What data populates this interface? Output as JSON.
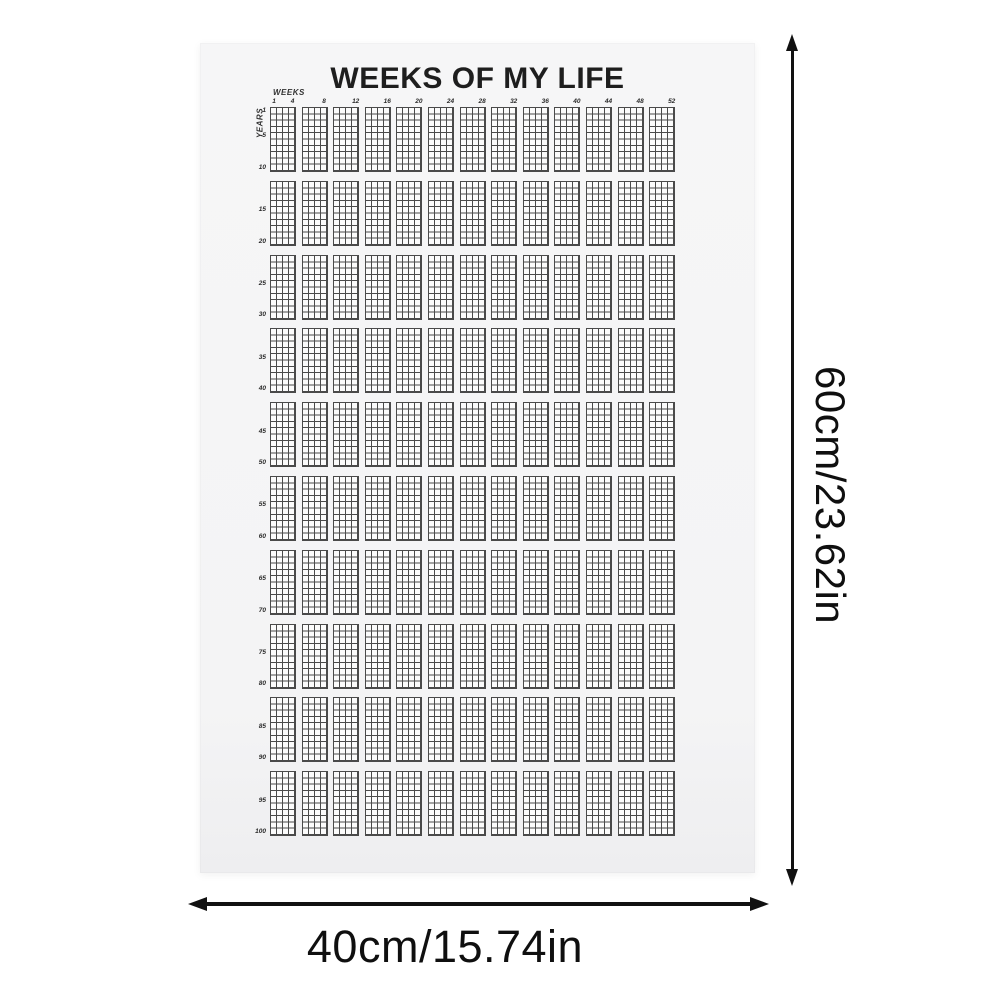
{
  "poster": {
    "title": "WEEKS OF MY LIFE",
    "weeks_axis_label": "WEEKS",
    "years_axis_label": "YEARS",
    "week_number_labels": [
      "1",
      "4",
      "8",
      "12",
      "16",
      "20",
      "24",
      "28",
      "32",
      "36",
      "40",
      "44",
      "48",
      "52"
    ],
    "year_number_labels": [
      "1",
      "5",
      "10",
      "15",
      "20",
      "25",
      "30",
      "35",
      "40",
      "45",
      "50",
      "55",
      "60",
      "65",
      "70",
      "75",
      "80",
      "85",
      "90",
      "95",
      "100"
    ],
    "grid": {
      "weeks_per_year": 52,
      "total_years": 100,
      "block_columns": 13,
      "block_rows": 10,
      "weeks_per_block": 4,
      "years_per_block": 10
    }
  },
  "dimensions": {
    "height_label": "60cm/23.62in",
    "width_label": "40cm/15.74in"
  },
  "colors": {
    "page_background": "#ffffff",
    "poster_background": "#f4f4f5",
    "grid_line": "#4a4a4a",
    "grid_cell": "#fbfbfb",
    "arrow": "#111111",
    "title_ink": "#1e1e1e"
  }
}
